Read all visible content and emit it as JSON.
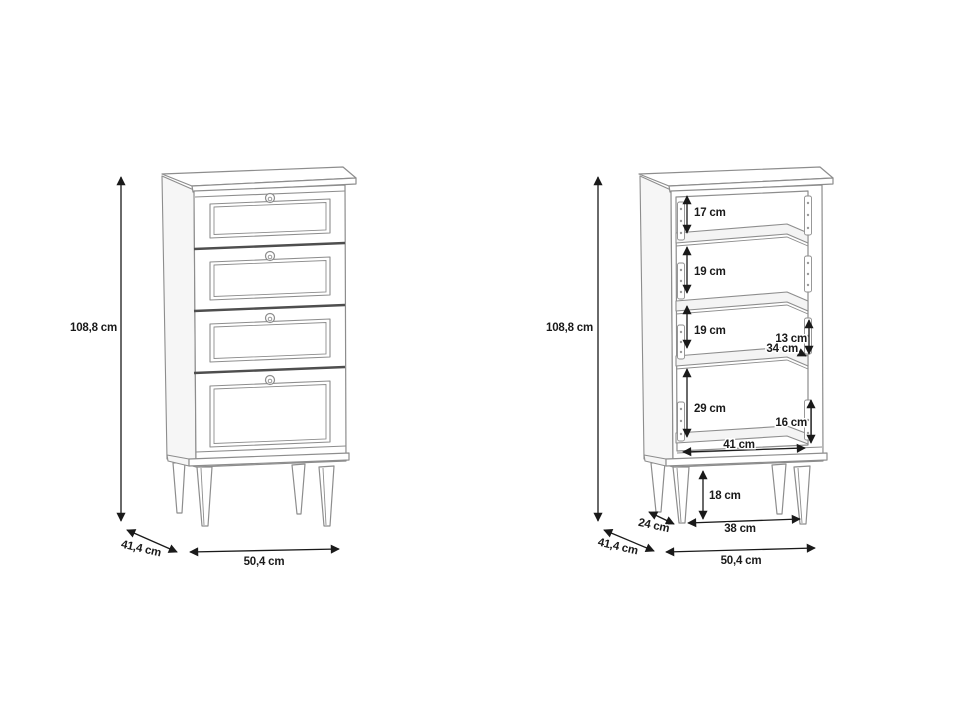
{
  "colors": {
    "background": "#ffffff",
    "cabinet_line": "#8d8d8d",
    "cabinet_line_dark": "#4e4e4e",
    "dimension_color": "#1a1a1a"
  },
  "left_view": {
    "height": "108,8 cm",
    "depth": "41,4 cm",
    "width": "50,4 cm"
  },
  "right_view": {
    "height": "108,8 cm",
    "depth": "41,4 cm",
    "width": "50,4 cm",
    "compartment1": "17 cm",
    "compartment2": "19 cm",
    "compartment3": "19 cm",
    "compartment4": "29 cm",
    "side_upper": "13 cm",
    "inner_depth": "34 cm",
    "side_lower": "16 cm",
    "inner_width": "41 cm",
    "leg_height": "18 cm",
    "leg_depth_span": "24 cm",
    "leg_width_span": "38 cm"
  }
}
